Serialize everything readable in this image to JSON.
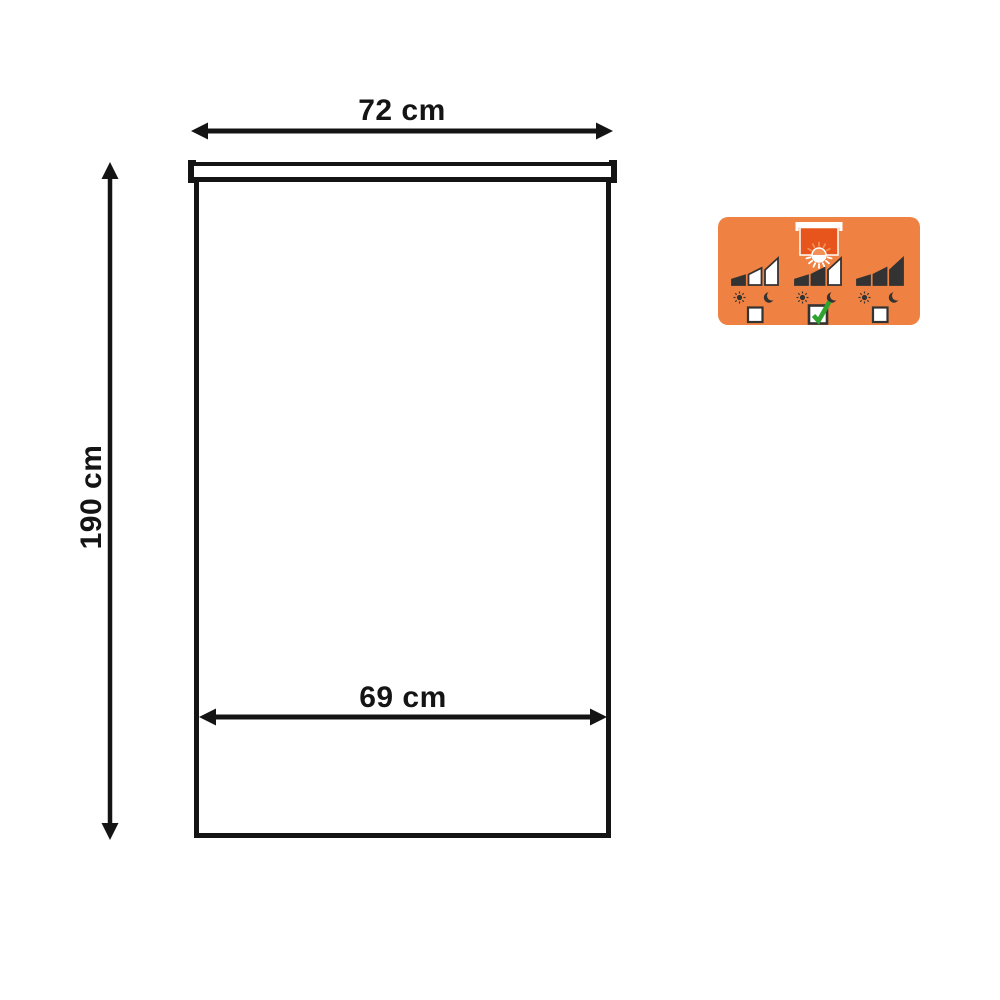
{
  "diagram": {
    "width_label": "72 cm",
    "height_label": "190 cm",
    "inner_width_label": "69 cm",
    "line_color": "#141414"
  },
  "badge": {
    "colors": {
      "background": "#EF8142",
      "fabric": "#E8551C",
      "sun_accent": "#F29055",
      "icon_dark": "#333333",
      "check_green": "#2EA32E",
      "white": "#FFFFFF"
    },
    "options": [
      {
        "filled_bars": 1,
        "total_bars": 3,
        "checked": false
      },
      {
        "filled_bars": 2,
        "total_bars": 3,
        "checked": true
      },
      {
        "filled_bars": 3,
        "total_bars": 3,
        "checked": false
      }
    ]
  }
}
